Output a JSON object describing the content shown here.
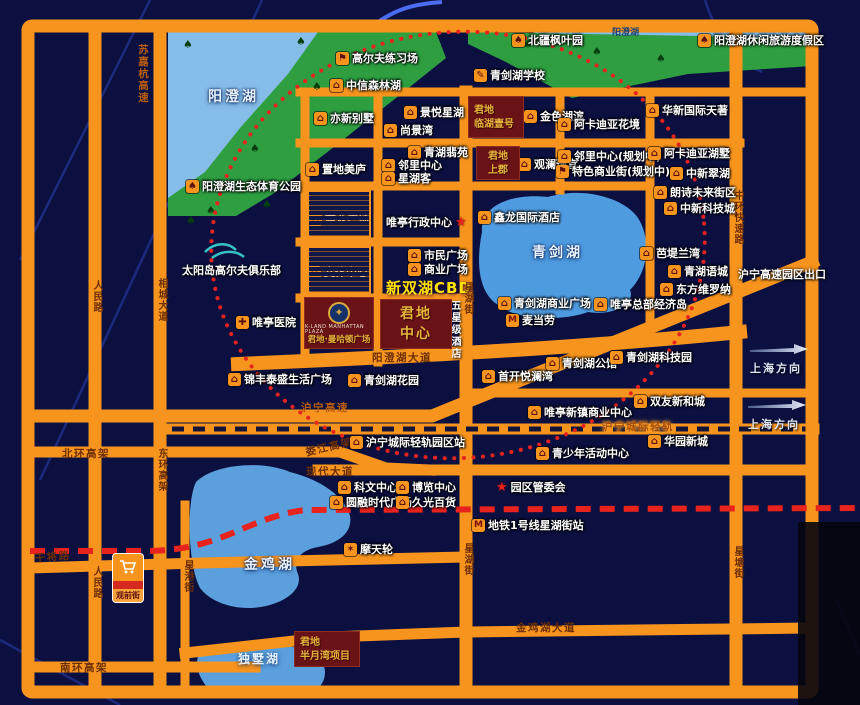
{
  "map": {
    "colors": {
      "background": "#0b1040",
      "road": "#f7941d",
      "park_green": "#2e9e41",
      "water": "#4f9be0",
      "red_route": "#e8231d",
      "project_box": "#6a1316",
      "project_text": "#e6b43c",
      "cbd_text": "#ffe400"
    },
    "labels": [
      {
        "t": "阳澄湖",
        "x": 208,
        "y": 86,
        "cls": "lake"
      },
      {
        "t": "青剑湖",
        "x": 532,
        "y": 242,
        "cls": "lake"
      },
      {
        "t": "金鸡湖",
        "x": 244,
        "y": 554,
        "cls": "lake"
      },
      {
        "t": "独墅湖",
        "x": 238,
        "y": 650,
        "cls": "lake-sm"
      },
      {
        "t": "阳澄湖",
        "x": 612,
        "y": 25,
        "cls": "tiny-dark"
      },
      {
        "t": "太阳岛高尔夫俱乐部",
        "x": 182,
        "y": 262,
        "cls": "white"
      },
      {
        "t": "沪宁高速园区出口",
        "x": 738,
        "y": 266,
        "cls": "white"
      },
      {
        "t": "五星级酒店",
        "x": 447,
        "y": 300,
        "cls": "white-v"
      },
      {
        "t": "新双湖CBD",
        "x": 386,
        "y": 277,
        "cls": "cbd"
      },
      {
        "t": "苏嘉杭高速",
        "x": 136,
        "y": 44,
        "cls": "road-v road-navy"
      },
      {
        "t": "人民路",
        "x": 89,
        "y": 280,
        "cls": "road-v"
      },
      {
        "t": "相城大道",
        "x": 154,
        "y": 278,
        "cls": "road-v"
      },
      {
        "t": "东环高架",
        "x": 154,
        "y": 448,
        "cls": "road-v"
      },
      {
        "t": "人民路",
        "x": 89,
        "y": 566,
        "cls": "road-v"
      },
      {
        "t": "星港街",
        "x": 180,
        "y": 560,
        "cls": "road-v"
      },
      {
        "t": "星湖街",
        "x": 460,
        "y": 282,
        "cls": "road-v"
      },
      {
        "t": "星湖街",
        "x": 460,
        "y": 543,
        "cls": "road-v"
      },
      {
        "t": "星塘街",
        "x": 730,
        "y": 546,
        "cls": "road-v"
      },
      {
        "t": "中环快速路",
        "x": 730,
        "y": 190,
        "cls": "road-v"
      },
      {
        "t": "北环高架",
        "x": 62,
        "y": 446,
        "cls": "road"
      },
      {
        "t": "娄江高架",
        "x": 304,
        "y": 445,
        "cls": "road",
        "rot": -13
      },
      {
        "t": "现代大道",
        "x": 306,
        "y": 464,
        "cls": "road"
      },
      {
        "t": "沪宁高速",
        "x": 301,
        "y": 400,
        "cls": "road-navy"
      },
      {
        "t": "沪宁城际轻轨",
        "x": 602,
        "y": 419,
        "cls": "road-glow"
      },
      {
        "t": "阳澄湖大道",
        "x": 372,
        "y": 350,
        "cls": "road"
      },
      {
        "t": "干将路",
        "x": 34,
        "y": 551,
        "cls": "road",
        "rot": -5
      },
      {
        "t": "南环高架",
        "x": 60,
        "y": 660,
        "cls": "road"
      },
      {
        "t": "金鸡湖大道",
        "x": 516,
        "y": 620,
        "cls": "road"
      }
    ],
    "pois": [
      {
        "icon": "golf",
        "x": 336,
        "y": 52,
        "label": "高尔夫练习场"
      },
      {
        "icon": "building",
        "x": 330,
        "y": 79,
        "label": "中信森林湖"
      },
      {
        "icon": "tree",
        "x": 512,
        "y": 34,
        "label": "北疆枫叶园"
      },
      {
        "icon": "tree",
        "x": 698,
        "y": 34,
        "label": "阳澄湖休闲旅游度假区"
      },
      {
        "icon": "school",
        "x": 474,
        "y": 69,
        "label": "青剑湖学校"
      },
      {
        "icon": "tree",
        "x": 186,
        "y": 180,
        "label": "阳澄湖生态体育公园"
      },
      {
        "icon": "building",
        "x": 314,
        "y": 112,
        "label": "亦新别墅"
      },
      {
        "icon": "building",
        "x": 404,
        "y": 106,
        "label": "景悦星湖"
      },
      {
        "icon": "building",
        "x": 384,
        "y": 124,
        "label": "尚景湾"
      },
      {
        "icon": "building",
        "x": 408,
        "y": 146,
        "label": "青湖翡苑"
      },
      {
        "icon": "building",
        "x": 382,
        "y": 159,
        "label": "邻里中心"
      },
      {
        "icon": "building",
        "x": 382,
        "y": 172,
        "label": "星湖客"
      },
      {
        "icon": "building",
        "x": 306,
        "y": 163,
        "label": "置地美庐"
      },
      {
        "icon": "building",
        "x": 524,
        "y": 110,
        "label": "金色湖滨"
      },
      {
        "icon": "building",
        "x": 558,
        "y": 118,
        "label": "阿卡迪亚花境"
      },
      {
        "icon": "building",
        "x": 646,
        "y": 104,
        "label": "华新国际天著"
      },
      {
        "icon": "building",
        "x": 518,
        "y": 158,
        "label": "观澜瑾宫"
      },
      {
        "icon": "building",
        "x": 558,
        "y": 150,
        "label": "邻里中心(规划中)"
      },
      {
        "icon": "shop",
        "x": 556,
        "y": 165,
        "label": "特色商业街(规划中)"
      },
      {
        "icon": "building",
        "x": 648,
        "y": 147,
        "label": "阿卡迪亚湖墅"
      },
      {
        "icon": "building",
        "x": 670,
        "y": 167,
        "label": "中新翠湖"
      },
      {
        "icon": "building",
        "x": 654,
        "y": 186,
        "label": "朗诗未来街区"
      },
      {
        "icon": "building",
        "x": 664,
        "y": 202,
        "label": "中新科技城"
      },
      {
        "icon": "building",
        "x": 478,
        "y": 211,
        "label": "鑫龙国际酒店"
      },
      {
        "icon": "building",
        "x": 640,
        "y": 247,
        "label": "芭堤兰湾"
      },
      {
        "icon": "building",
        "x": 668,
        "y": 265,
        "label": "青湖语城"
      },
      {
        "icon": "building",
        "x": 660,
        "y": 283,
        "label": "东方维罗纳"
      },
      {
        "icon": "building",
        "x": 498,
        "y": 297,
        "label": "青剑湖商业广场"
      },
      {
        "icon": "mcd",
        "x": 506,
        "y": 314,
        "label": "麦当劳"
      },
      {
        "icon": "building",
        "x": 594,
        "y": 298,
        "label": "唯亭总部经济岛"
      },
      {
        "icon": "cross",
        "x": 236,
        "y": 316,
        "label": "唯亭医院"
      },
      {
        "icon": "building",
        "x": 228,
        "y": 373,
        "label": "锦丰泰盛生活广场"
      },
      {
        "icon": "building",
        "x": 348,
        "y": 374,
        "label": "青剑湖花园"
      },
      {
        "icon": "building",
        "x": 482,
        "y": 370,
        "label": "首开悦澜湾"
      },
      {
        "icon": "building",
        "x": 546,
        "y": 357,
        "label": "青剑湖公馆"
      },
      {
        "icon": "building",
        "x": 610,
        "y": 351,
        "label": "青剑湖科技园"
      },
      {
        "icon": "building",
        "x": 634,
        "y": 395,
        "label": "双友新和城"
      },
      {
        "icon": "building",
        "x": 528,
        "y": 406,
        "label": "唯亭新镇商业中心"
      },
      {
        "icon": "building",
        "x": 648,
        "y": 435,
        "label": "华园新城"
      },
      {
        "icon": "building",
        "x": 536,
        "y": 447,
        "label": "青少年活动中心"
      },
      {
        "icon": "building",
        "x": 350,
        "y": 436,
        "label": "沪宁城际轻轨园区站"
      },
      {
        "icon": "building",
        "x": 338,
        "y": 481,
        "label": "科文中心"
      },
      {
        "icon": "building",
        "x": 396,
        "y": 481,
        "label": "博览中心"
      },
      {
        "icon": "building",
        "x": 330,
        "y": 496,
        "label": "圆融时代广场"
      },
      {
        "icon": "building",
        "x": 396,
        "y": 496,
        "label": "久光百货"
      },
      {
        "icon": "star",
        "x": 496,
        "y": 481,
        "label": "园区管委会"
      },
      {
        "icon": "star_after",
        "x": 386,
        "y": 216,
        "label": "唯亭行政中心"
      },
      {
        "icon": "building",
        "x": 309,
        "y": 213,
        "label": "商业广场"
      },
      {
        "icon": "building",
        "x": 308,
        "y": 266,
        "label": "文体中心"
      },
      {
        "icon": "building",
        "x": 408,
        "y": 249,
        "label": "市民广场"
      },
      {
        "icon": "building",
        "x": 408,
        "y": 263,
        "label": "商业广场"
      },
      {
        "icon": "metro",
        "x": 472,
        "y": 519,
        "label": "地铁1号线星湖街站"
      },
      {
        "icon": "ferris",
        "x": 344,
        "y": 543,
        "label": "摩天轮"
      }
    ],
    "projects": [
      {
        "x": 468,
        "y": 96,
        "w": 56,
        "h": 42,
        "cls": "",
        "lines": [
          "君地",
          "临湖壹号"
        ]
      },
      {
        "x": 476,
        "y": 146,
        "w": 44,
        "h": 34,
        "cls": "center",
        "lines": [
          "君地",
          "上郡"
        ]
      },
      {
        "x": 380,
        "y": 299,
        "w": 72,
        "h": 50,
        "cls": "center big",
        "lines": [
          "君地",
          "中心"
        ]
      },
      {
        "x": 294,
        "y": 631,
        "w": 66,
        "h": 36,
        "cls": "",
        "lines": [
          "君地",
          "半月湾项目"
        ]
      }
    ],
    "hatch_blocks": [
      {
        "x": 307,
        "y": 190,
        "w": 64,
        "h": 48
      },
      {
        "x": 307,
        "y": 246,
        "w": 64,
        "h": 48
      }
    ],
    "arrows": [
      {
        "x": 750,
        "y": 340,
        "t": "上海方向"
      },
      {
        "x": 748,
        "y": 396,
        "t": "上海方向"
      }
    ],
    "plaza": {
      "emblem_glyph": "✦",
      "sub": "K-LAND MANHATTAN PLAZA",
      "name": "君地·曼哈顿广场"
    },
    "guanqian_logo": {
      "name": "观前街"
    }
  }
}
